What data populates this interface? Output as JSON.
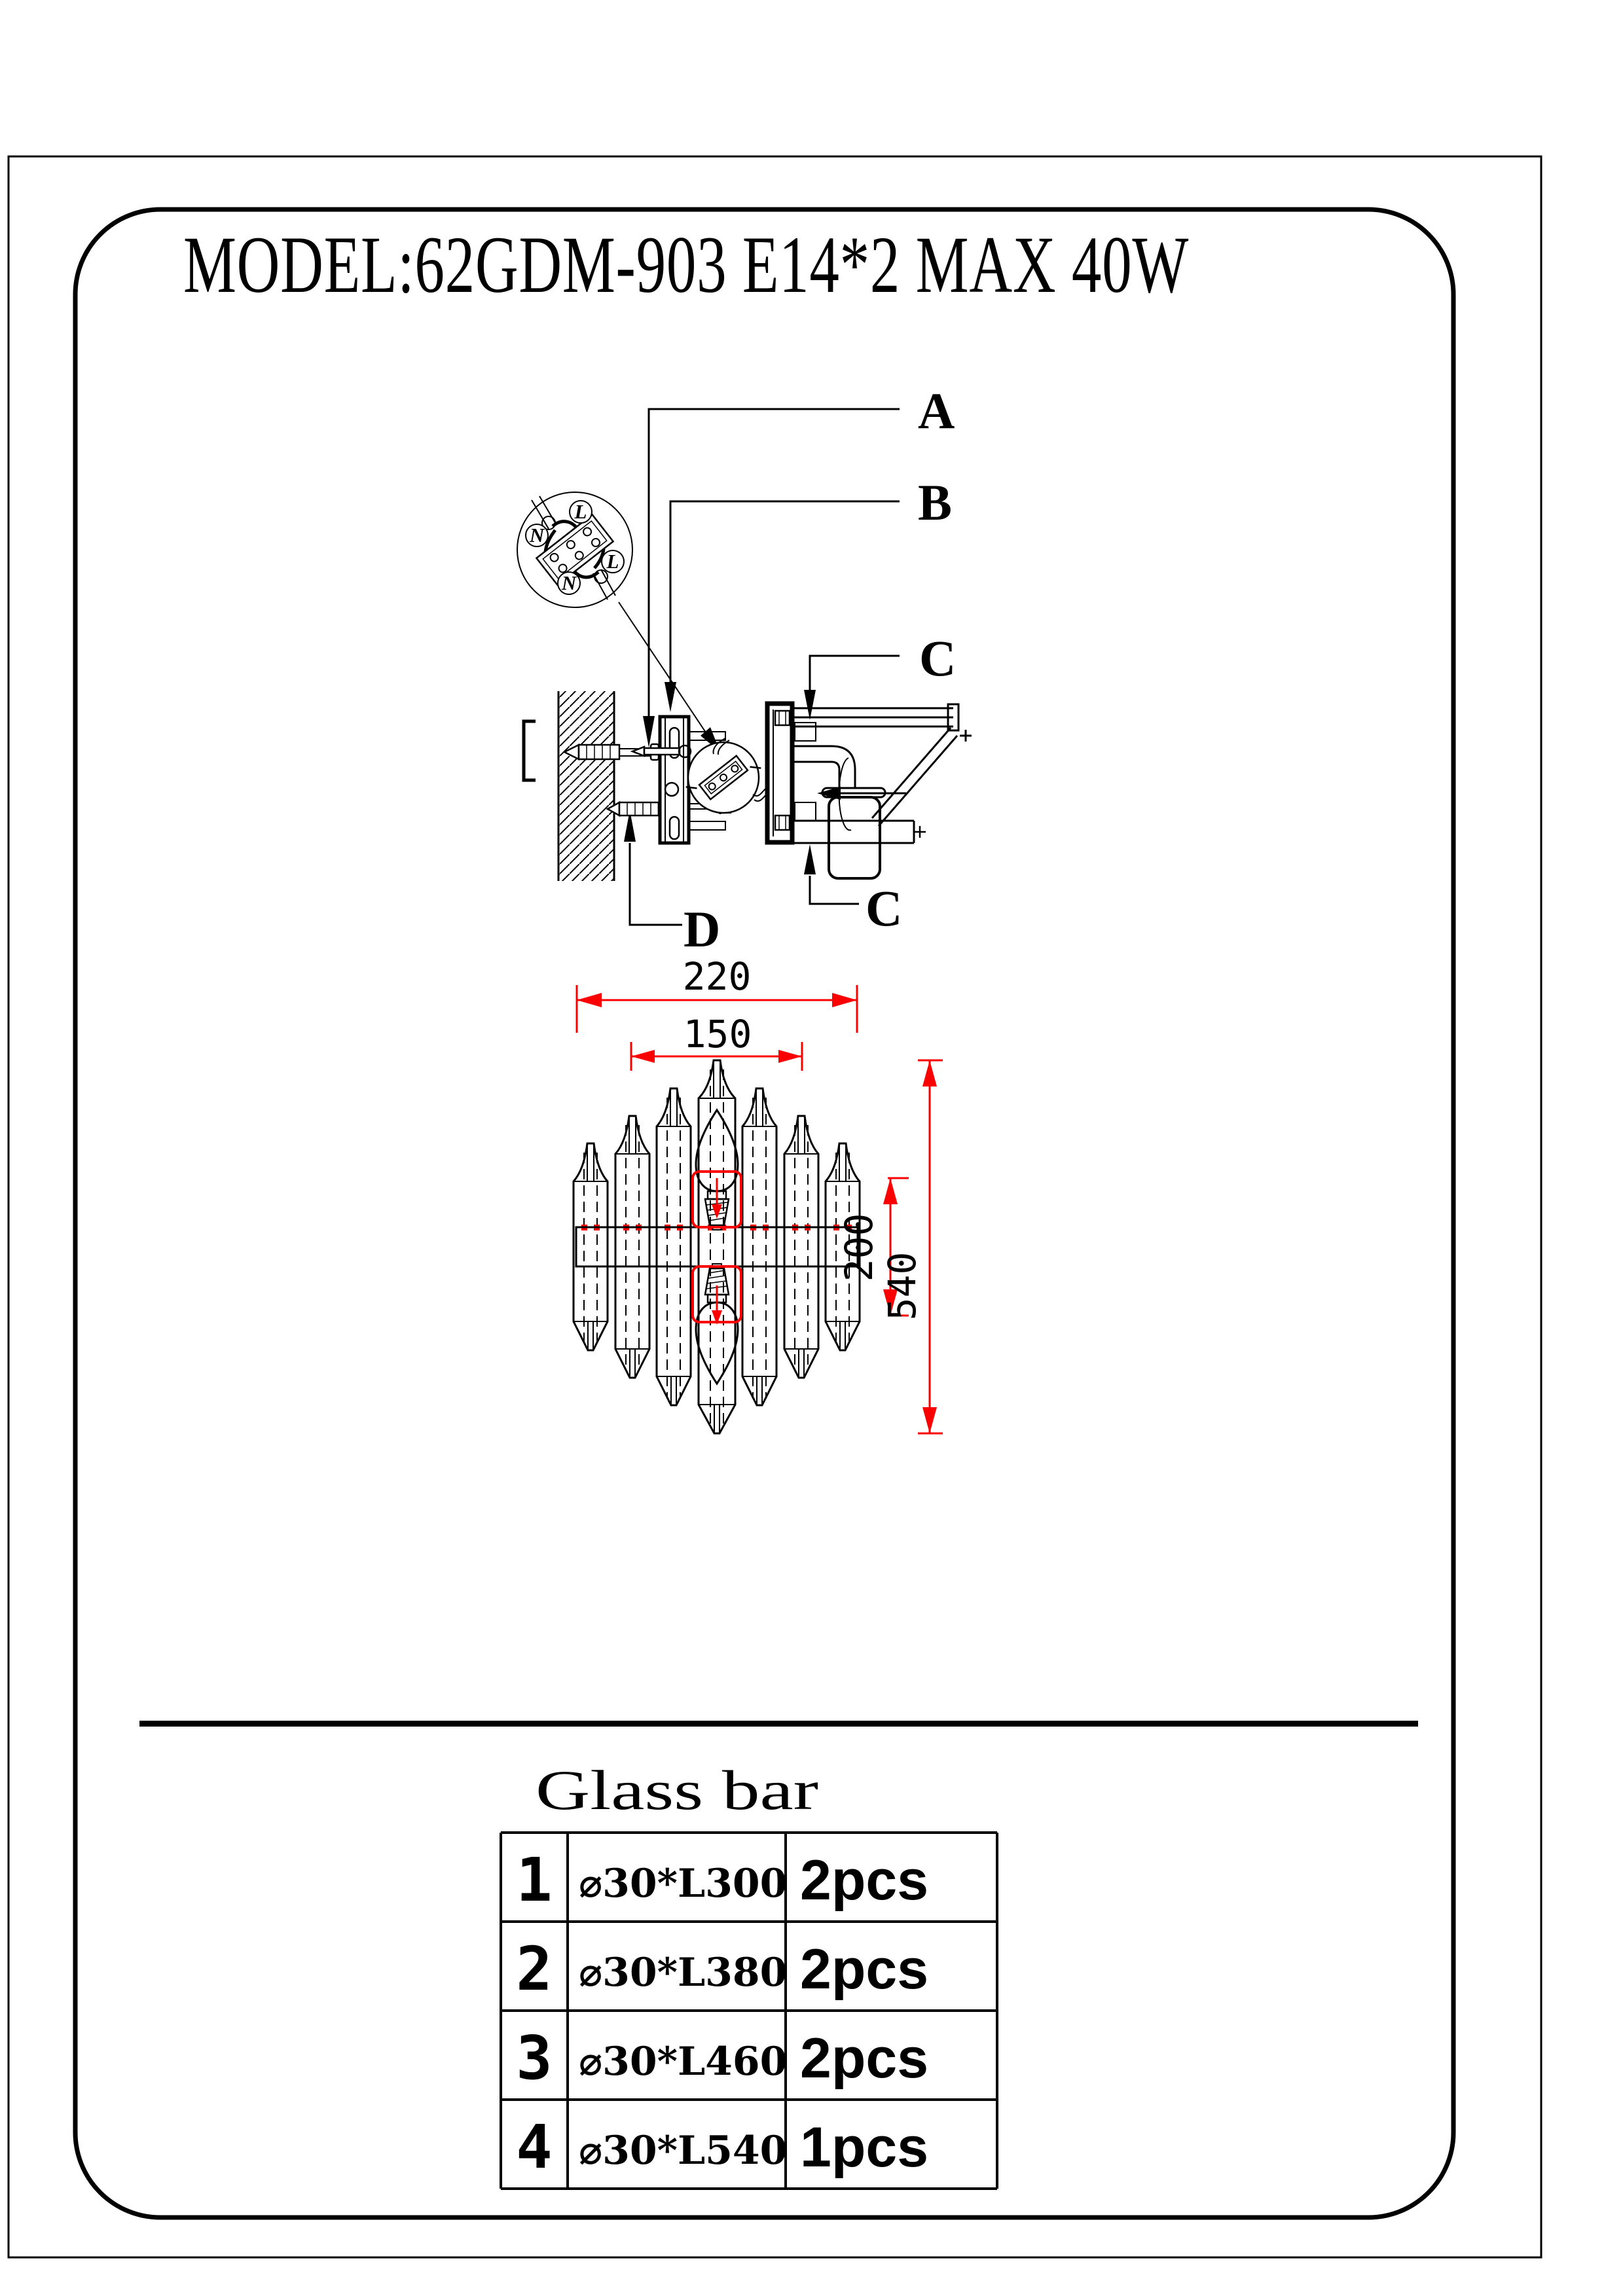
{
  "colors": {
    "line": "#000000",
    "dimension_red": "#fa0000",
    "background": "#ffffff"
  },
  "title": "MODEL:62GDM-903 E14*2 MAX 40W",
  "install": {
    "label_a": "A",
    "label_b": "B",
    "label_c_top": "C",
    "label_c_bottom": "C",
    "label_d": "D",
    "wiring": {
      "l_top": "L",
      "n_left": "N",
      "l_right": "L",
      "n_bottom": "N"
    }
  },
  "dimensions": {
    "overall_width": "220",
    "inner_width": "150",
    "socket_spacing": "200",
    "overall_height": "540"
  },
  "glass_bar": {
    "title": "Glass bar",
    "rows": [
      {
        "no": "1",
        "size": "⌀30*L300",
        "qty": "2pcs"
      },
      {
        "no": "2",
        "size": "⌀30*L380",
        "qty": "2pcs"
      },
      {
        "no": "3",
        "size": "⌀30*L460",
        "qty": "2pcs"
      },
      {
        "no": "4",
        "size": "⌀30*L540",
        "qty": "1pcs"
      }
    ]
  }
}
